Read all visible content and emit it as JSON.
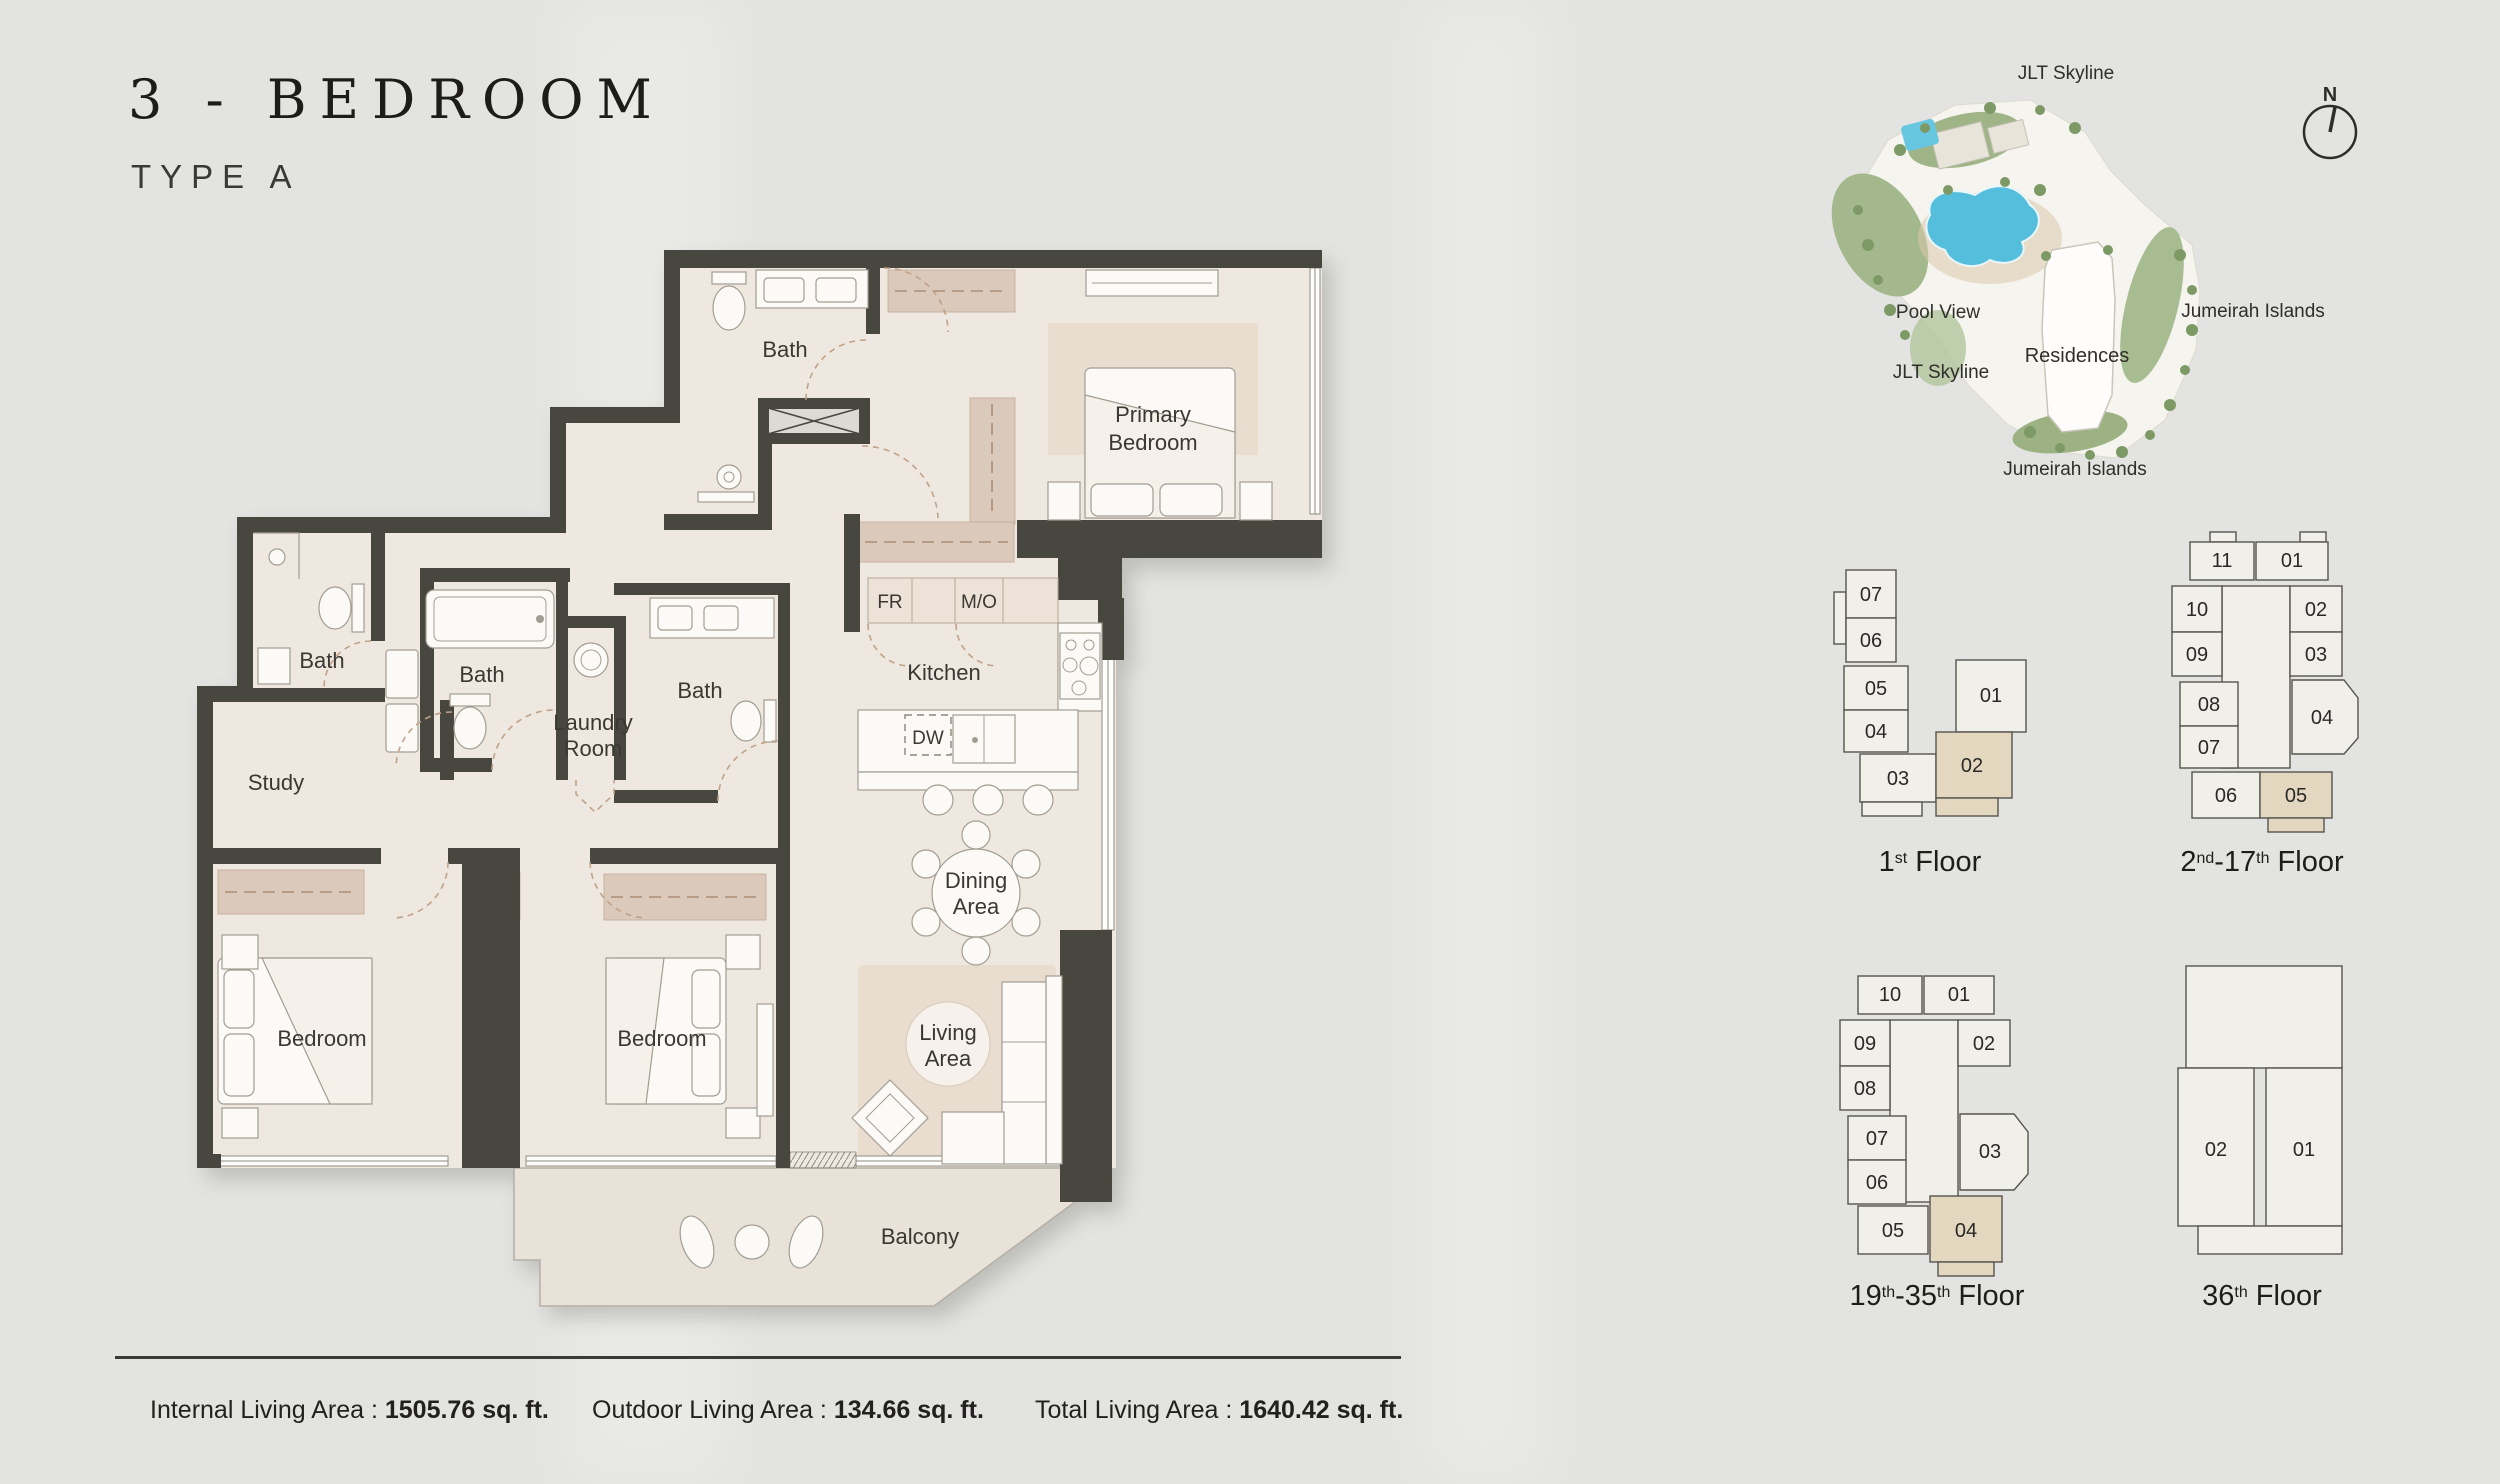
{
  "title": {
    "main": "3 - BEDROOM",
    "sub": "TYPE A"
  },
  "plan": {
    "rooms": {
      "bath_top": "Bath",
      "bath_left": "Bath",
      "bath_center": "Bath",
      "bath_right": "Bath",
      "laundry_1": "Laundry",
      "laundry_2": "Room",
      "study": "Study",
      "kitchen": "Kitchen",
      "fr": "FR",
      "mo": "M/O",
      "dw": "DW",
      "primary_1": "Primary",
      "primary_2": "Bedroom",
      "dining_1": "Dining",
      "dining_2": "Area",
      "living_1": "Living",
      "living_2": "Area",
      "bedroom_left": "Bedroom",
      "bedroom_right": "Bedroom",
      "balcony": "Balcony"
    }
  },
  "site": {
    "compass": "N",
    "labels": {
      "skyline_top": "JLT Skyline",
      "pool_view": "Pool View",
      "islands_right": "Jumeirah Islands",
      "skyline_left": "JLT Skyline",
      "residences": "Residences",
      "islands_bottom": "Jumeirah Islands"
    }
  },
  "keyplans": {
    "f1": {
      "units": [
        "07",
        "06",
        "05",
        "04",
        "03",
        "02",
        "01"
      ],
      "highlighted_unit": "02",
      "label": {
        "p1": "1",
        "s1": "st",
        "p2": " Floor",
        "s2": "",
        "p3": ""
      }
    },
    "f2_17": {
      "units": [
        "11",
        "01",
        "10",
        "02",
        "09",
        "03",
        "08",
        "04",
        "07",
        "06",
        "05"
      ],
      "highlighted_unit": "05",
      "label": {
        "p1": "2",
        "s1": "nd",
        "p2": "-17",
        "s2": "th",
        "p3": " Floor"
      }
    },
    "f19_35": {
      "units": [
        "10",
        "01",
        "09",
        "02",
        "08",
        "07",
        "03",
        "06",
        "05",
        "04"
      ],
      "highlighted_unit": "04",
      "label": {
        "p1": "19",
        "s1": "th",
        "p2": "-35",
        "s2": "th",
        "p3": " Floor"
      }
    },
    "f36": {
      "units": [
        "02",
        "01"
      ],
      "highlighted_unit": "",
      "label": {
        "p1": "36",
        "s1": "th",
        "p2": " Floor",
        "s2": "",
        "p3": ""
      }
    }
  },
  "stats": [
    {
      "label": "Internal Living Area : ",
      "value": "1505.76 sq. ft."
    },
    {
      "label": "Outdoor Living Area : ",
      "value": "134.66 sq. ft."
    },
    {
      "label": "Total Living Area : ",
      "value": "1640.42 sq. ft."
    }
  ],
  "colors": {
    "page_background": "#e3e4e1",
    "walls": "#47463f",
    "floor": "#efe8e0",
    "closet": "#dbc9bb",
    "unit_highlight": "#e3d7bf",
    "pool_blue": "#55bedd",
    "landscape_green": "#a3b88c",
    "ink": "#22211e"
  }
}
